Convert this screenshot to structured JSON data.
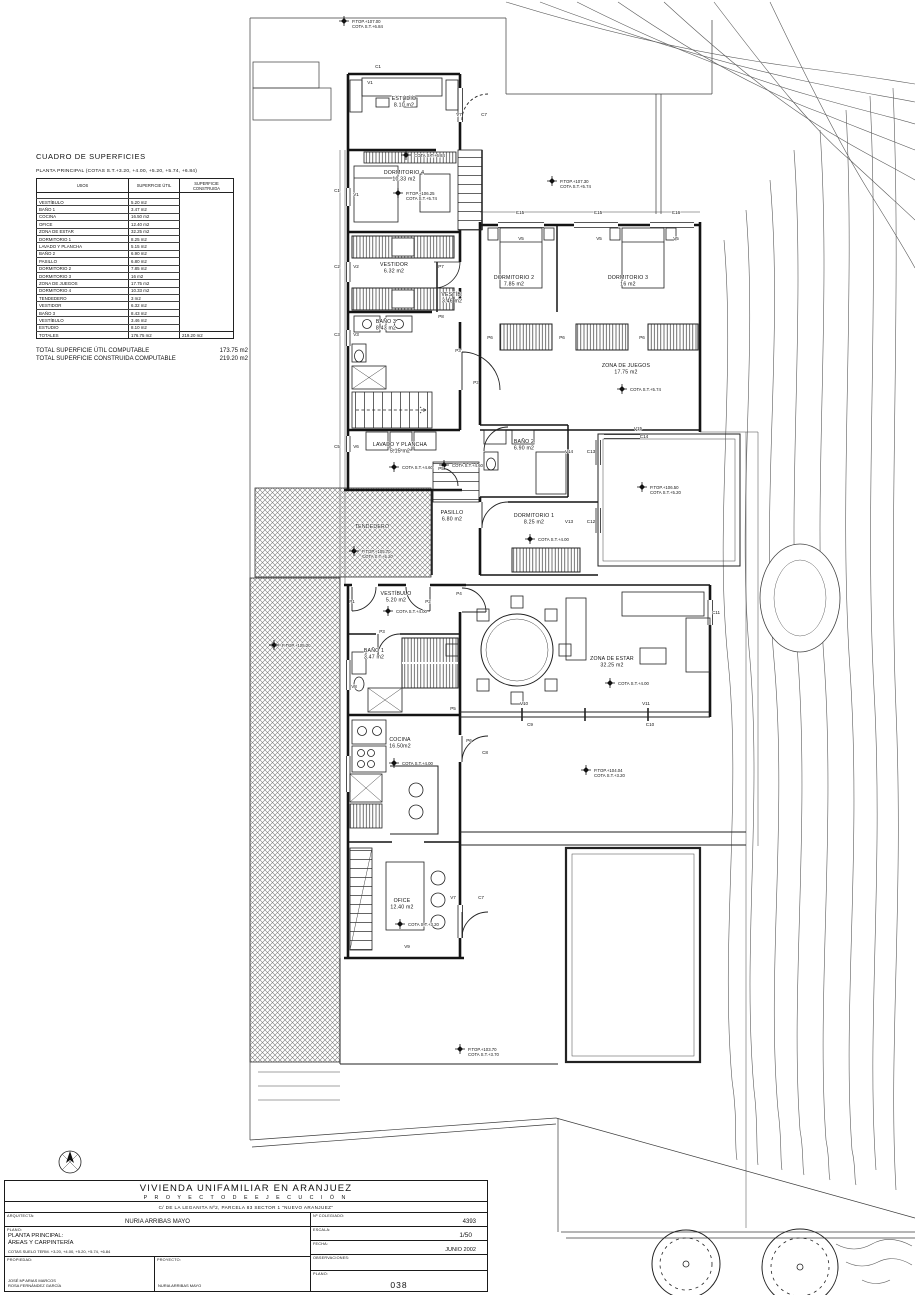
{
  "surfaces_panel": {
    "title": "CUADRO DE SUPERFICIES",
    "subtitle": "PLANTA PRINCIPAL (COTAS S.T.+3.20, +4.00, +5.20, +5.74, +6.84)",
    "columns": [
      "USOS",
      "SUPERFICIE ÚTIL",
      "SUPERFICIE CONSTRUIDA"
    ],
    "rows": [
      [
        "",
        ""
      ],
      [
        "VESTÍBULO",
        "5.20 m2"
      ],
      [
        "BAÑO 1",
        "3.47 m2"
      ],
      [
        "COCINA",
        "16.50 m2"
      ],
      [
        "OFICE",
        "12.40 m2"
      ],
      [
        "ZONA DE ESTAR",
        "32.25 m2"
      ],
      [
        "DORMITORIO 1",
        "8.25 m2"
      ],
      [
        "LAVADO Y PLANCHA",
        "5.15 m2"
      ],
      [
        "BAÑO 2",
        "6.90 m2"
      ],
      [
        "PASILLO",
        "6.80 m2"
      ],
      [
        "DORMITORIO 2",
        "7.85 m2"
      ],
      [
        "DORMITORIO 3",
        "16 m2"
      ],
      [
        "ZONA DE JUEGOS",
        "17.75 m2"
      ],
      [
        "DORMITORIO 4",
        "10.33 m2"
      ],
      [
        "TENDEDERO",
        "3 m2"
      ],
      [
        "VESTIDOR",
        "6.32 m2"
      ],
      [
        "BAÑO 3",
        "8.43 m2"
      ],
      [
        "VESTÍBULO",
        "3.46 m2"
      ],
      [
        "ESTUDIO",
        "8.10 m2"
      ]
    ],
    "totals_row": [
      "TOTALES",
      "176.75 m2",
      "219.20 m2"
    ],
    "total_lines": [
      {
        "label": "TOTAL SUPERFICIE ÚTIL COMPUTABLE",
        "value": "173.75 m2"
      },
      {
        "label": "TOTAL SUPERFICIE CONSTRUIDA COMPUTABLE",
        "value": "219.20 m2"
      }
    ]
  },
  "plan": {
    "rooms": [
      {
        "name": "ESTUDIO",
        "area": "8.10 m2",
        "x": 404,
        "y": 100
      },
      {
        "name": "DORMITORIO 4",
        "area": "10.33 m2",
        "x": 404,
        "y": 174
      },
      {
        "name": "VESTIDOR",
        "area": "6.32 m2",
        "x": 394,
        "y": 266
      },
      {
        "name": "VESTÍB.",
        "area": "3.46 m2",
        "x": 452,
        "y": 296
      },
      {
        "name": "BAÑO 3",
        "area": "8.43 m2",
        "x": 386,
        "y": 323
      },
      {
        "name": "DORMITORIO 2",
        "area": "7.85 m2",
        "x": 514,
        "y": 279
      },
      {
        "name": "DORMITORIO 3",
        "area": "16 m2",
        "x": 628,
        "y": 279
      },
      {
        "name": "ZONA DE JUEGOS",
        "area": "17.75 m2",
        "x": 626,
        "y": 367
      },
      {
        "name": "LAVADO Y PLANCHA",
        "area": "5.15 m2",
        "x": 400,
        "y": 446
      },
      {
        "name": "BAÑO 2",
        "area": "6.90 m2",
        "x": 524,
        "y": 443
      },
      {
        "name": "PASILLO",
        "area": "6.80 m2",
        "x": 452,
        "y": 514
      },
      {
        "name": "DORMITORIO 1",
        "area": "8.25 m2",
        "x": 534,
        "y": 517
      },
      {
        "name": "TENDEDERO",
        "area": "",
        "x": 372,
        "y": 528
      },
      {
        "name": "VESTÍBULO",
        "area": "5.20 m2",
        "x": 396,
        "y": 595
      },
      {
        "name": "BAÑO 1",
        "area": "3.47 m2",
        "x": 374,
        "y": 652
      },
      {
        "name": "ZONA DE ESTAR",
        "area": "32.25 m2",
        "x": 612,
        "y": 660
      },
      {
        "name": "COCINA",
        "area": "16.50m2",
        "x": 400,
        "y": 741
      },
      {
        "name": "OFICE",
        "area": "12.40 m2",
        "x": 402,
        "y": 902
      }
    ],
    "cotas": [
      {
        "lines": [
          "P.TOP.+107.00",
          "COTA S.T.+6.84"
        ],
        "x": 352,
        "y": 24
      },
      {
        "lines": [
          "COTA S.T.+6.84"
        ],
        "x": 414,
        "y": 158
      },
      {
        "lines": [
          "P.TOP.+107.30",
          "COTA S.T.+5.74"
        ],
        "x": 560,
        "y": 184
      },
      {
        "lines": [
          "P.TOP.+106.25",
          "COTA S.T.+5.74"
        ],
        "x": 406,
        "y": 196
      },
      {
        "lines": [
          "COTA S.T.+5.74"
        ],
        "x": 630,
        "y": 392
      },
      {
        "lines": [
          "COTA S.T.+4.60"
        ],
        "x": 402,
        "y": 470
      },
      {
        "lines": [
          "COTA S.T.+4.60"
        ],
        "x": 452,
        "y": 468
      },
      {
        "lines": [
          "P.TOP.+105.70",
          "COTA S.T.+5.20"
        ],
        "x": 362,
        "y": 554
      },
      {
        "lines": [
          "P.TOP.+105.20"
        ],
        "x": 282,
        "y": 648
      },
      {
        "lines": [
          "P.TOP.+106.50",
          "COTA S.T.+5.20"
        ],
        "x": 650,
        "y": 490
      },
      {
        "lines": [
          "COTA S.T.+4.00"
        ],
        "x": 538,
        "y": 542
      },
      {
        "lines": [
          "COTA S.T.+4.00"
        ],
        "x": 396,
        "y": 614
      },
      {
        "lines": [
          "COTA S.T.+4.00"
        ],
        "x": 618,
        "y": 686
      },
      {
        "lines": [
          "COTA S.T.+4.00"
        ],
        "x": 402,
        "y": 766
      },
      {
        "lines": [
          "COTA S.T.+3.20"
        ],
        "x": 408,
        "y": 927
      },
      {
        "lines": [
          "P.TOP.+104.04",
          "COTA S.T.+3.20"
        ],
        "x": 594,
        "y": 773
      },
      {
        "lines": [
          "P.TOP.+103.70",
          "COTA S.T.+3.70"
        ],
        "x": 468,
        "y": 1052
      }
    ],
    "codes": [
      {
        "text": "C1",
        "x": 378,
        "y": 68
      },
      {
        "text": "V1",
        "x": 370,
        "y": 84
      },
      {
        "text": "V7",
        "x": 459,
        "y": 116
      },
      {
        "text": "C7",
        "x": 484,
        "y": 116
      },
      {
        "text": "C1",
        "x": 337,
        "y": 192
      },
      {
        "text": "V1",
        "x": 356,
        "y": 196
      },
      {
        "text": "C2",
        "x": 337,
        "y": 268
      },
      {
        "text": "V2",
        "x": 356,
        "y": 268
      },
      {
        "text": "P7",
        "x": 441,
        "y": 268
      },
      {
        "text": "C3",
        "x": 337,
        "y": 336
      },
      {
        "text": "V3",
        "x": 356,
        "y": 336
      },
      {
        "text": "P8",
        "x": 441,
        "y": 318
      },
      {
        "text": "P3",
        "x": 458,
        "y": 352
      },
      {
        "text": "P3",
        "x": 476,
        "y": 384
      },
      {
        "text": "C5",
        "x": 337,
        "y": 448
      },
      {
        "text": "V6",
        "x": 356,
        "y": 448
      },
      {
        "text": "P5",
        "x": 441,
        "y": 470
      },
      {
        "text": "C15",
        "x": 520,
        "y": 214
      },
      {
        "text": "C15",
        "x": 598,
        "y": 214
      },
      {
        "text": "C16",
        "x": 676,
        "y": 214
      },
      {
        "text": "V5",
        "x": 521,
        "y": 240
      },
      {
        "text": "V5",
        "x": 599,
        "y": 240
      },
      {
        "text": "V5",
        "x": 676,
        "y": 240
      },
      {
        "text": "P6",
        "x": 490,
        "y": 339
      },
      {
        "text": "P6",
        "x": 562,
        "y": 339
      },
      {
        "text": "P6",
        "x": 642,
        "y": 339
      },
      {
        "text": "V15",
        "x": 638,
        "y": 430
      },
      {
        "text": "C14",
        "x": 644,
        "y": 438
      },
      {
        "text": "V14",
        "x": 569,
        "y": 453
      },
      {
        "text": "C13",
        "x": 591,
        "y": 453
      },
      {
        "text": "V13",
        "x": 569,
        "y": 523
      },
      {
        "text": "C12",
        "x": 591,
        "y": 523
      },
      {
        "text": "P1",
        "x": 352,
        "y": 603
      },
      {
        "text": "P2",
        "x": 428,
        "y": 603
      },
      {
        "text": "P4",
        "x": 459,
        "y": 595
      },
      {
        "text": "P3",
        "x": 382,
        "y": 633
      },
      {
        "text": "V8",
        "x": 354,
        "y": 688
      },
      {
        "text": "P5",
        "x": 453,
        "y": 710
      },
      {
        "text": "V10",
        "x": 524,
        "y": 705
      },
      {
        "text": "V11",
        "x": 646,
        "y": 705
      },
      {
        "text": "C9",
        "x": 530,
        "y": 726
      },
      {
        "text": "C10",
        "x": 650,
        "y": 726
      },
      {
        "text": "C11",
        "x": 716,
        "y": 614
      },
      {
        "text": "P6",
        "x": 469,
        "y": 742
      },
      {
        "text": "C8",
        "x": 485,
        "y": 754
      },
      {
        "text": "V7",
        "x": 453,
        "y": 899
      },
      {
        "text": "C7",
        "x": 481,
        "y": 899
      },
      {
        "text": "V9",
        "x": 407,
        "y": 948
      }
    ]
  },
  "title_block": {
    "project_title": "VIVIENDA UNIFAMILIAR EN ARANJUEZ",
    "project_subtitle": "P R O Y E C T O   D E   E J E C U C I Ó N",
    "address": "C/ DE LA LEGANITA Nº2, PARCELA 83  SECTOR 1 \"NUEVO ARANJUEZ\"",
    "architect_label": "ARQUITECTA:",
    "architect_name": "NURIA ARRIBAS MAYO",
    "college_label": "Nº COLEGIADO:",
    "college_number": "4393",
    "plan_label": "PLANO:",
    "plan_name_line1": "PLANTA PRINCIPAL:",
    "plan_name_line2": "ÁREAS Y CARPINTERÍA",
    "plan_name_line3": "COTAS SUELO TERM. +3.20, +4.00, +5.20, +5.74, +6.84",
    "scale_label": "ESCALA:",
    "scale_value": "1/50",
    "date_label": "FECHA:",
    "date_value": "JUNIO 2002",
    "observations_label": "OBSERVACIONES:",
    "property_label": "PROPIEDAD:",
    "property_name1": "JOSÉ Mª ARIAS MARCOS",
    "property_name2": "ROSA FERNÁNDEZ GARCÍA",
    "project_by_label": "PROYECTO:",
    "project_by_name": "NURIA ARRIBAS MAYO",
    "sheet_label": "PLANO:",
    "sheet_number": "038"
  }
}
